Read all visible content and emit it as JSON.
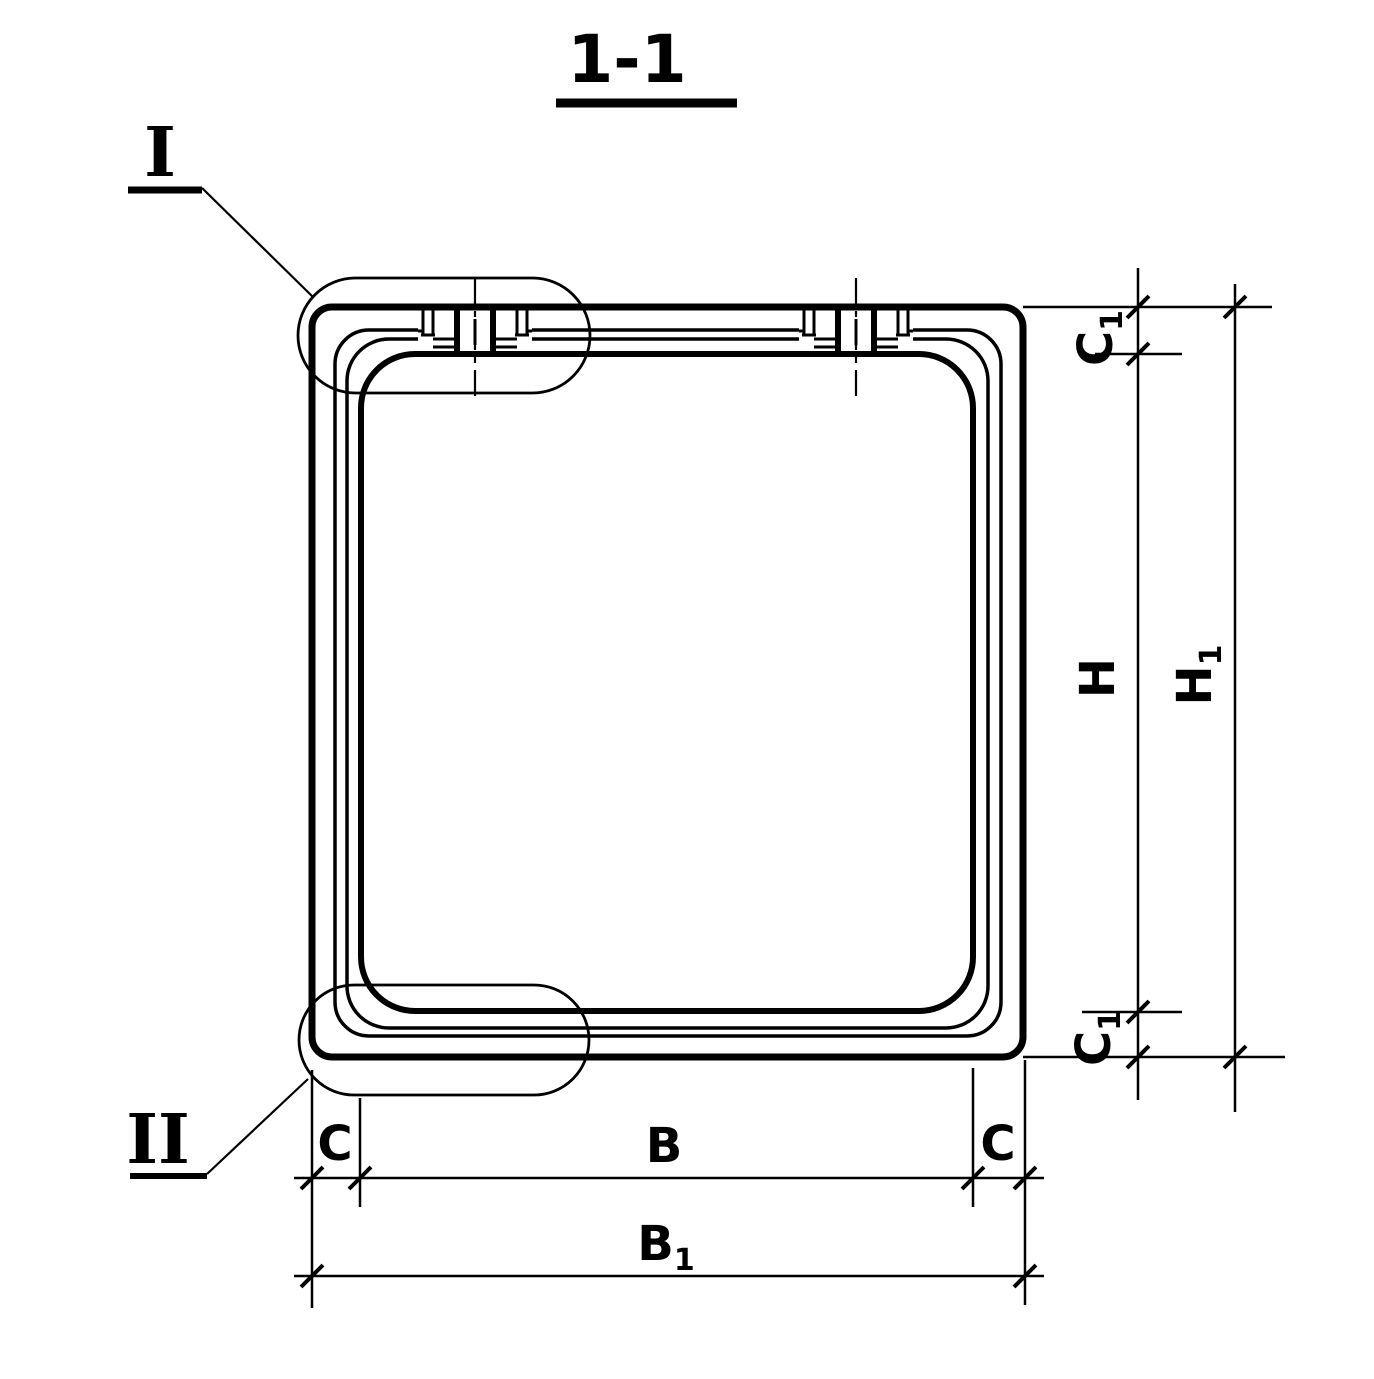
{
  "sheet": {
    "background": "#ffffff",
    "ink": "#000000"
  },
  "title": {
    "text": "1-1"
  },
  "details": {
    "i": {
      "label": "I"
    },
    "ii": {
      "label": "II"
    }
  },
  "dims": {
    "b": {
      "base": "B",
      "sub": ""
    },
    "b1": {
      "base": "B",
      "sub": "1"
    },
    "c_left": {
      "base": "C",
      "sub": ""
    },
    "c_right": {
      "base": "C",
      "sub": ""
    },
    "h": {
      "base": "H",
      "sub": ""
    },
    "h1": {
      "base": "H",
      "sub": "1"
    },
    "c1_top": {
      "base": "C",
      "sub": "1"
    },
    "c1_bottom": {
      "base": "C",
      "sub": "1"
    }
  }
}
